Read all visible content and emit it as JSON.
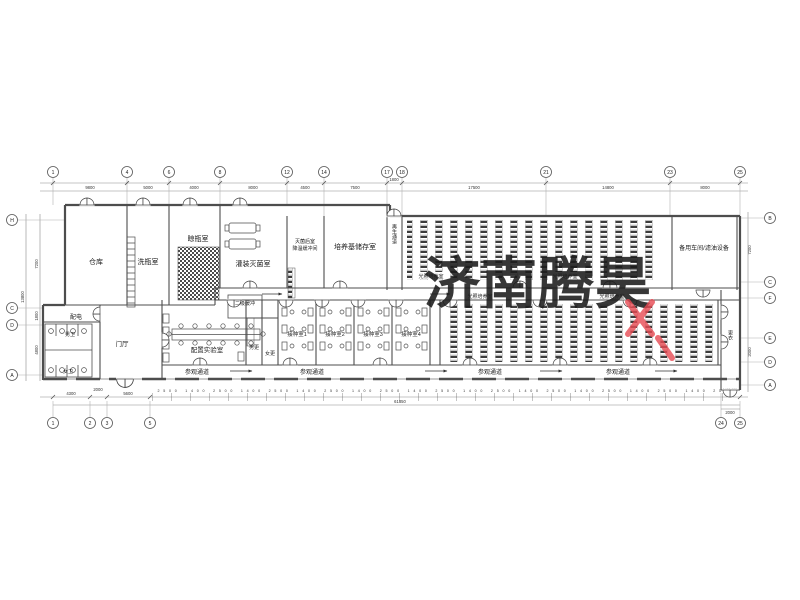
{
  "watermark": {
    "text": "济南腾昊",
    "color": "#e74a52"
  },
  "rooms": {
    "warehouse": "仓库",
    "wash": "洗瓶室",
    "dry": "晾瓶室",
    "fill": "灌装灭菌室",
    "post_sterile": "灭菌后室",
    "cool_buffer": "降温缓冲间",
    "medium_storage": "培养基储存室",
    "regen_corridor": "再生通道",
    "light_culture": "光照培养室",
    "backup": "备用车间/滤油设备",
    "power": "配电",
    "male_wc": "男卫",
    "female_wc": "女卫",
    "foyer": "门厅",
    "secondary_buffer": "二级缓冲",
    "prep_lab": "配置实验室",
    "male_change": "男更",
    "female_change": "女更",
    "inoc1": "接种室1",
    "inoc2": "接种室2",
    "inoc3": "接种室3",
    "inoc4": "接种室4",
    "visit_corridor": "参观通道",
    "change_corridor": "更衣"
  },
  "grid": {
    "top": [
      "1",
      "4",
      "6",
      "8",
      "12",
      "14",
      "17",
      "18",
      "21",
      "23",
      "25"
    ],
    "bottom": [
      "1",
      "2",
      "3",
      "5",
      "24",
      "25"
    ],
    "left": [
      "H",
      "C",
      "D",
      "A"
    ],
    "right": [
      "B",
      "C",
      "F",
      "E",
      "D",
      "A"
    ]
  },
  "dims": {
    "top": [
      "9800",
      "5000",
      "4000",
      "8000",
      "4500",
      "7500",
      "1800",
      "17500",
      "14800",
      "8000"
    ],
    "left": [
      "7200",
      "1800",
      "4800"
    ],
    "left_total": "13800",
    "right": [
      "7200",
      "2000"
    ],
    "bottom_left": [
      "4300",
      "2000",
      "5600"
    ],
    "bottom_run": [
      "2500",
      "1400",
      "2500",
      "1400",
      "2500",
      "1400",
      "2500",
      "1400",
      "2500",
      "1400",
      "2500",
      "1400",
      "2500",
      "1400",
      "2500",
      "1400",
      "2500",
      "1400",
      "2500",
      "1400",
      "2500"
    ],
    "bottom_total": "61850",
    "bottom_right": [
      "1400",
      "600"
    ],
    "bottom_right_total": "2000"
  }
}
